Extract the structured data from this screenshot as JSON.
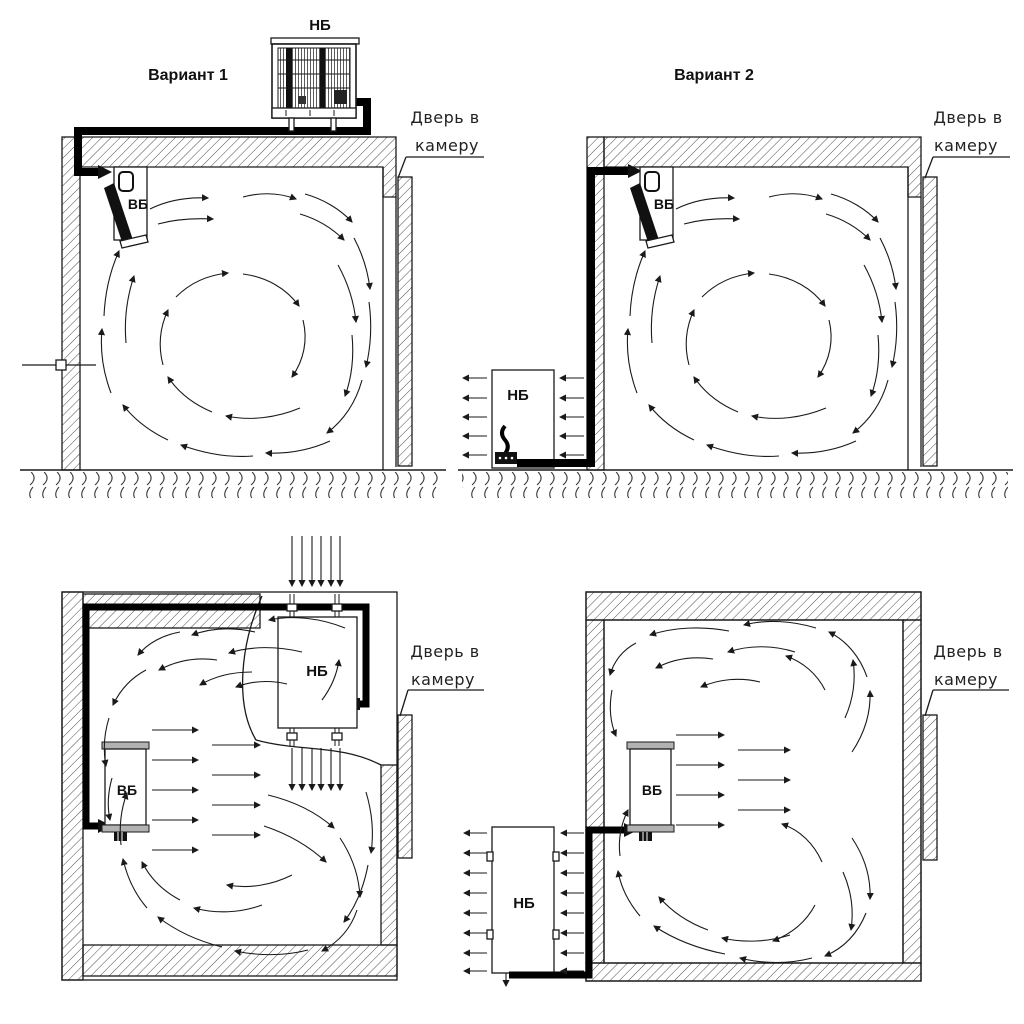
{
  "page": {
    "background": "#ffffff",
    "line_color": "#1a1a1a",
    "pipe_color": "#000000"
  },
  "panels": {
    "top_left": {
      "title": "Вариант 1",
      "outdoor_unit_label": "НБ",
      "indoor_unit_label": "ВБ",
      "door_label_line1": "Дверь в",
      "door_label_line2": "камеру"
    },
    "top_right": {
      "title": "Вариант 2",
      "outdoor_unit_label": "НБ",
      "indoor_unit_label": "ВБ",
      "door_label_line1": "Дверь в",
      "door_label_line2": "камеру"
    },
    "bottom_left": {
      "outdoor_unit_label": "НБ",
      "indoor_unit_label": "ВБ",
      "door_label_line1": "Дверь в",
      "door_label_line2": "камеру"
    },
    "bottom_right": {
      "outdoor_unit_label": "НБ",
      "indoor_unit_label": "ВБ",
      "door_label_line1": "Дверь в",
      "door_label_line2": "камеру"
    }
  }
}
